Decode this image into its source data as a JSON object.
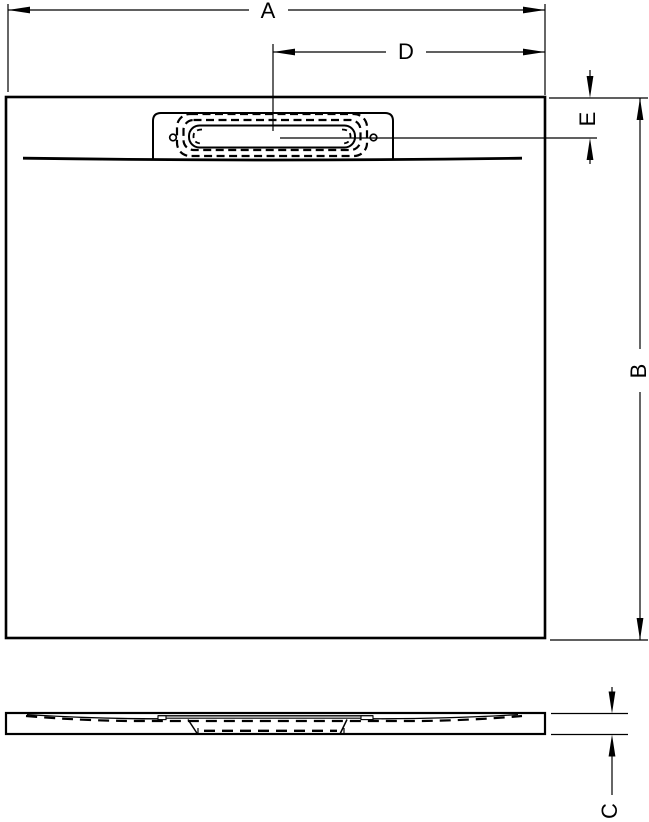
{
  "drawing": {
    "type": "technical-dimension-drawing",
    "subject": "square shower tray with linear drain cover, plan view and side profile view",
    "colors": {
      "line": "#000000",
      "background": "#ffffff"
    },
    "dimensions": {
      "overall_width": {
        "label": "A",
        "orientation": "horizontal",
        "measures": "overall width of tray (plan view, top)"
      },
      "drain_center_offset": {
        "label": "D",
        "orientation": "horizontal",
        "measures": "drain centre to right edge (plan view)"
      },
      "drain_edge_distance": {
        "label": "E",
        "orientation": "vertical",
        "measures": "top edge to drain centre line (plan view, right side)"
      },
      "overall_depth": {
        "label": "B",
        "orientation": "vertical",
        "measures": "overall depth of tray (plan view, far right)"
      },
      "tray_height": {
        "label": "C",
        "orientation": "vertical",
        "measures": "tray thickness (side profile view, bottom right)"
      }
    }
  }
}
